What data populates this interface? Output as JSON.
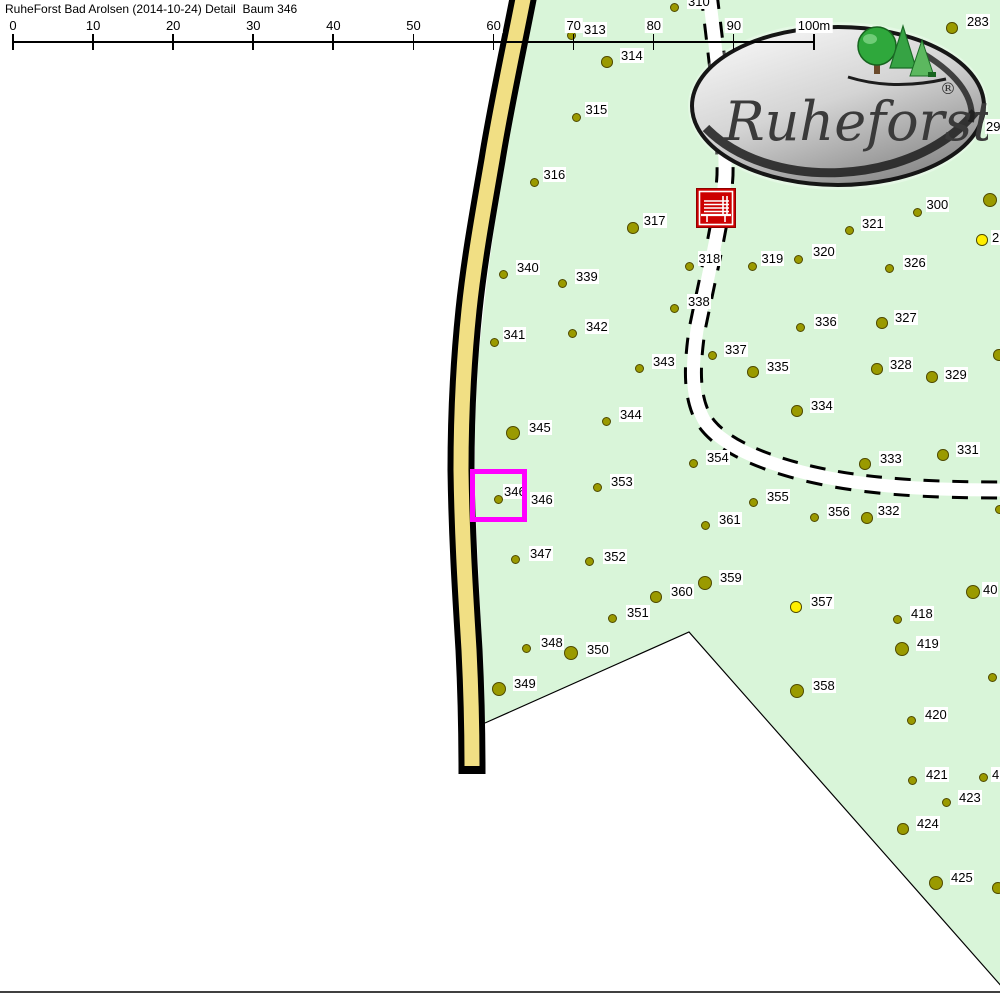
{
  "title": "RuheForst Bad Arolsen (2014-10-24) Detail  Baum 346",
  "logo": {
    "brand": "Ruheforst",
    "registered": "®"
  },
  "scale_bar": {
    "unit_labels": [
      "0",
      "10",
      "20",
      "30",
      "40",
      "50",
      "60",
      "70",
      "80",
      "90",
      "100m"
    ],
    "x0": 12,
    "dx": 80.1
  },
  "map": {
    "colors": {
      "forest_fill": "#d9f5d9",
      "road_fill": "#f1df84",
      "tree_fill": "#9a9a00",
      "tree_special_fill": "#ffee00",
      "tree_stroke": "#4f4a00",
      "highlight": "#ff00ff",
      "bench_red": "#cc0000"
    },
    "highlighted_tree": "346",
    "trees": [
      {
        "n": "310",
        "x": 674,
        "y": 7,
        "s": "s",
        "lx": 687,
        "ly": -6
      },
      {
        "n": "313",
        "x": 571,
        "y": 35,
        "s": "s",
        "lx": 583,
        "ly": 22
      },
      {
        "n": "314",
        "x": 607,
        "y": 62,
        "s": "m",
        "lx": 620,
        "ly": 48
      },
      {
        "n": "315",
        "x": 576,
        "y": 117,
        "s": "s"
      },
      {
        "n": "316",
        "x": 534,
        "y": 182,
        "s": "s"
      },
      {
        "n": "317",
        "x": 633,
        "y": 228,
        "s": "m"
      },
      {
        "n": "318",
        "x": 689,
        "y": 266,
        "s": "s"
      },
      {
        "n": "319",
        "x": 752,
        "y": 266,
        "s": "s"
      },
      {
        "n": "320",
        "x": 798,
        "y": 259,
        "s": "s",
        "lx": 812,
        "ly": 244
      },
      {
        "n": "321",
        "x": 849,
        "y": 230,
        "s": "s",
        "lx": 861,
        "ly": 216
      },
      {
        "n": "326",
        "x": 889,
        "y": 268,
        "s": "s",
        "lx": 903,
        "ly": 255
      },
      {
        "n": "327",
        "x": 882,
        "y": 323,
        "s": "m",
        "lx": 894,
        "ly": 310
      },
      {
        "n": "328",
        "x": 877,
        "y": 369,
        "s": "m",
        "lx": 889,
        "ly": 357
      },
      {
        "n": "329",
        "x": 932,
        "y": 377,
        "s": "m",
        "lx": 944,
        "ly": 367
      },
      {
        "n": "300",
        "x": 917,
        "y": 212,
        "s": "s"
      },
      {
        "n": "283",
        "x": 952,
        "y": 28,
        "s": "m",
        "lx": 966,
        "ly": 14
      },
      {
        "n": "331",
        "x": 943,
        "y": 455,
        "s": "m",
        "lx": 956,
        "ly": 442
      },
      {
        "n": "332",
        "x": 867,
        "y": 518,
        "s": "m"
      },
      {
        "n": "333",
        "x": 865,
        "y": 464,
        "s": "m",
        "lx": 879,
        "ly": 451
      },
      {
        "n": "334",
        "x": 797,
        "y": 411,
        "s": "m",
        "lx": 810,
        "ly": 398
      },
      {
        "n": "335",
        "x": 753,
        "y": 372,
        "s": "m",
        "lx": 766,
        "ly": 359
      },
      {
        "n": "336",
        "x": 800,
        "y": 327,
        "s": "s",
        "lx": 814,
        "ly": 314
      },
      {
        "n": "337",
        "x": 712,
        "y": 355,
        "s": "s",
        "lx": 724,
        "ly": 342
      },
      {
        "n": "338",
        "x": 674,
        "y": 308,
        "s": "s",
        "lx": 687,
        "ly": 294
      },
      {
        "n": "339",
        "x": 562,
        "y": 283,
        "s": "s",
        "lx": 575,
        "ly": 269
      },
      {
        "n": "340",
        "x": 503,
        "y": 274,
        "s": "s",
        "lx": 516,
        "ly": 260
      },
      {
        "n": "341",
        "x": 494,
        "y": 342,
        "s": "s"
      },
      {
        "n": "342",
        "x": 572,
        "y": 333,
        "s": "s",
        "lx": 585,
        "ly": 319
      },
      {
        "n": "343",
        "x": 639,
        "y": 368,
        "s": "s",
        "lx": 652,
        "ly": 354
      },
      {
        "n": "344",
        "x": 606,
        "y": 421,
        "s": "s",
        "lx": 619,
        "ly": 407
      },
      {
        "n": "345",
        "x": 513,
        "y": 433,
        "s": "l",
        "lx": 528,
        "ly": 420
      },
      {
        "n": "346",
        "x": 498,
        "y": 499,
        "s": "s",
        "lx": 530,
        "ly": 492
      },
      {
        "n": "347",
        "x": 515,
        "y": 559,
        "s": "s",
        "lx": 529,
        "ly": 546
      },
      {
        "n": "348",
        "x": 526,
        "y": 648,
        "s": "s",
        "lx": 540,
        "ly": 635
      },
      {
        "n": "349",
        "x": 499,
        "y": 689,
        "s": "l",
        "lx": 513,
        "ly": 676
      },
      {
        "n": "350",
        "x": 571,
        "y": 653,
        "s": "l",
        "lx": 586,
        "ly": 642
      },
      {
        "n": "351",
        "x": 612,
        "y": 618,
        "s": "s",
        "lx": 626,
        "ly": 605
      },
      {
        "n": "352",
        "x": 589,
        "y": 561,
        "s": "s",
        "lx": 603,
        "ly": 549
      },
      {
        "n": "353",
        "x": 597,
        "y": 487,
        "s": "s",
        "lx": 610,
        "ly": 474
      },
      {
        "n": "354",
        "x": 693,
        "y": 463,
        "s": "s",
        "lx": 706,
        "ly": 450
      },
      {
        "n": "355",
        "x": 753,
        "y": 502,
        "s": "s",
        "lx": 766,
        "ly": 489
      },
      {
        "n": "356",
        "x": 814,
        "y": 517,
        "s": "s",
        "lx": 827,
        "ly": 504
      },
      {
        "n": "357",
        "x": 796,
        "y": 607,
        "s": "m",
        "c": "y",
        "lx": 810,
        "ly": 594
      },
      {
        "n": "358",
        "x": 797,
        "y": 691,
        "s": "l",
        "lx": 812,
        "ly": 678
      },
      {
        "n": "359",
        "x": 705,
        "y": 583,
        "s": "l",
        "lx": 719,
        "ly": 570
      },
      {
        "n": "360",
        "x": 656,
        "y": 597,
        "s": "m",
        "lx": 670,
        "ly": 584
      },
      {
        "n": "361",
        "x": 705,
        "y": 525,
        "s": "s",
        "lx": 718,
        "ly": 512
      },
      {
        "n": "418",
        "x": 897,
        "y": 619,
        "s": "s",
        "lx": 910,
        "ly": 606
      },
      {
        "n": "419",
        "x": 902,
        "y": 649,
        "s": "l",
        "lx": 916,
        "ly": 636
      },
      {
        "n": "420",
        "x": 911,
        "y": 720,
        "s": "s",
        "lx": 924,
        "ly": 707
      },
      {
        "n": "421",
        "x": 912,
        "y": 780,
        "s": "s",
        "lx": 925,
        "ly": 767
      },
      {
        "n": "423",
        "x": 946,
        "y": 802,
        "s": "s",
        "lx": 958,
        "ly": 790
      },
      {
        "n": "424",
        "x": 903,
        "y": 829,
        "s": "m",
        "lx": 916,
        "ly": 816
      },
      {
        "n": "425",
        "x": 936,
        "y": 883,
        "s": "l",
        "lx": 950,
        "ly": 870
      },
      {
        "n": "",
        "x": 990,
        "y": 200,
        "s": "l"
      },
      {
        "n": "",
        "x": 982,
        "y": 240,
        "s": "m",
        "c": "y"
      },
      {
        "n": "",
        "x": 999,
        "y": 355,
        "s": "m"
      },
      {
        "n": "",
        "x": 999,
        "y": 509,
        "s": "s"
      },
      {
        "n": "",
        "x": 973,
        "y": 592,
        "s": "l"
      },
      {
        "n": "",
        "x": 992,
        "y": 677,
        "s": "s"
      },
      {
        "n": "",
        "x": 983,
        "y": 777,
        "s": "s"
      },
      {
        "n": "",
        "x": 998,
        "y": 888,
        "s": "m"
      }
    ],
    "extra_labels": [
      {
        "t": "346",
        "x": 503,
        "y": 484
      },
      {
        "t": "29",
        "x": 985,
        "y": 119
      },
      {
        "t": "2",
        "x": 991,
        "y": 230
      },
      {
        "t": "40",
        "x": 982,
        "y": 582
      },
      {
        "t": "4",
        "x": 991,
        "y": 767
      }
    ]
  }
}
